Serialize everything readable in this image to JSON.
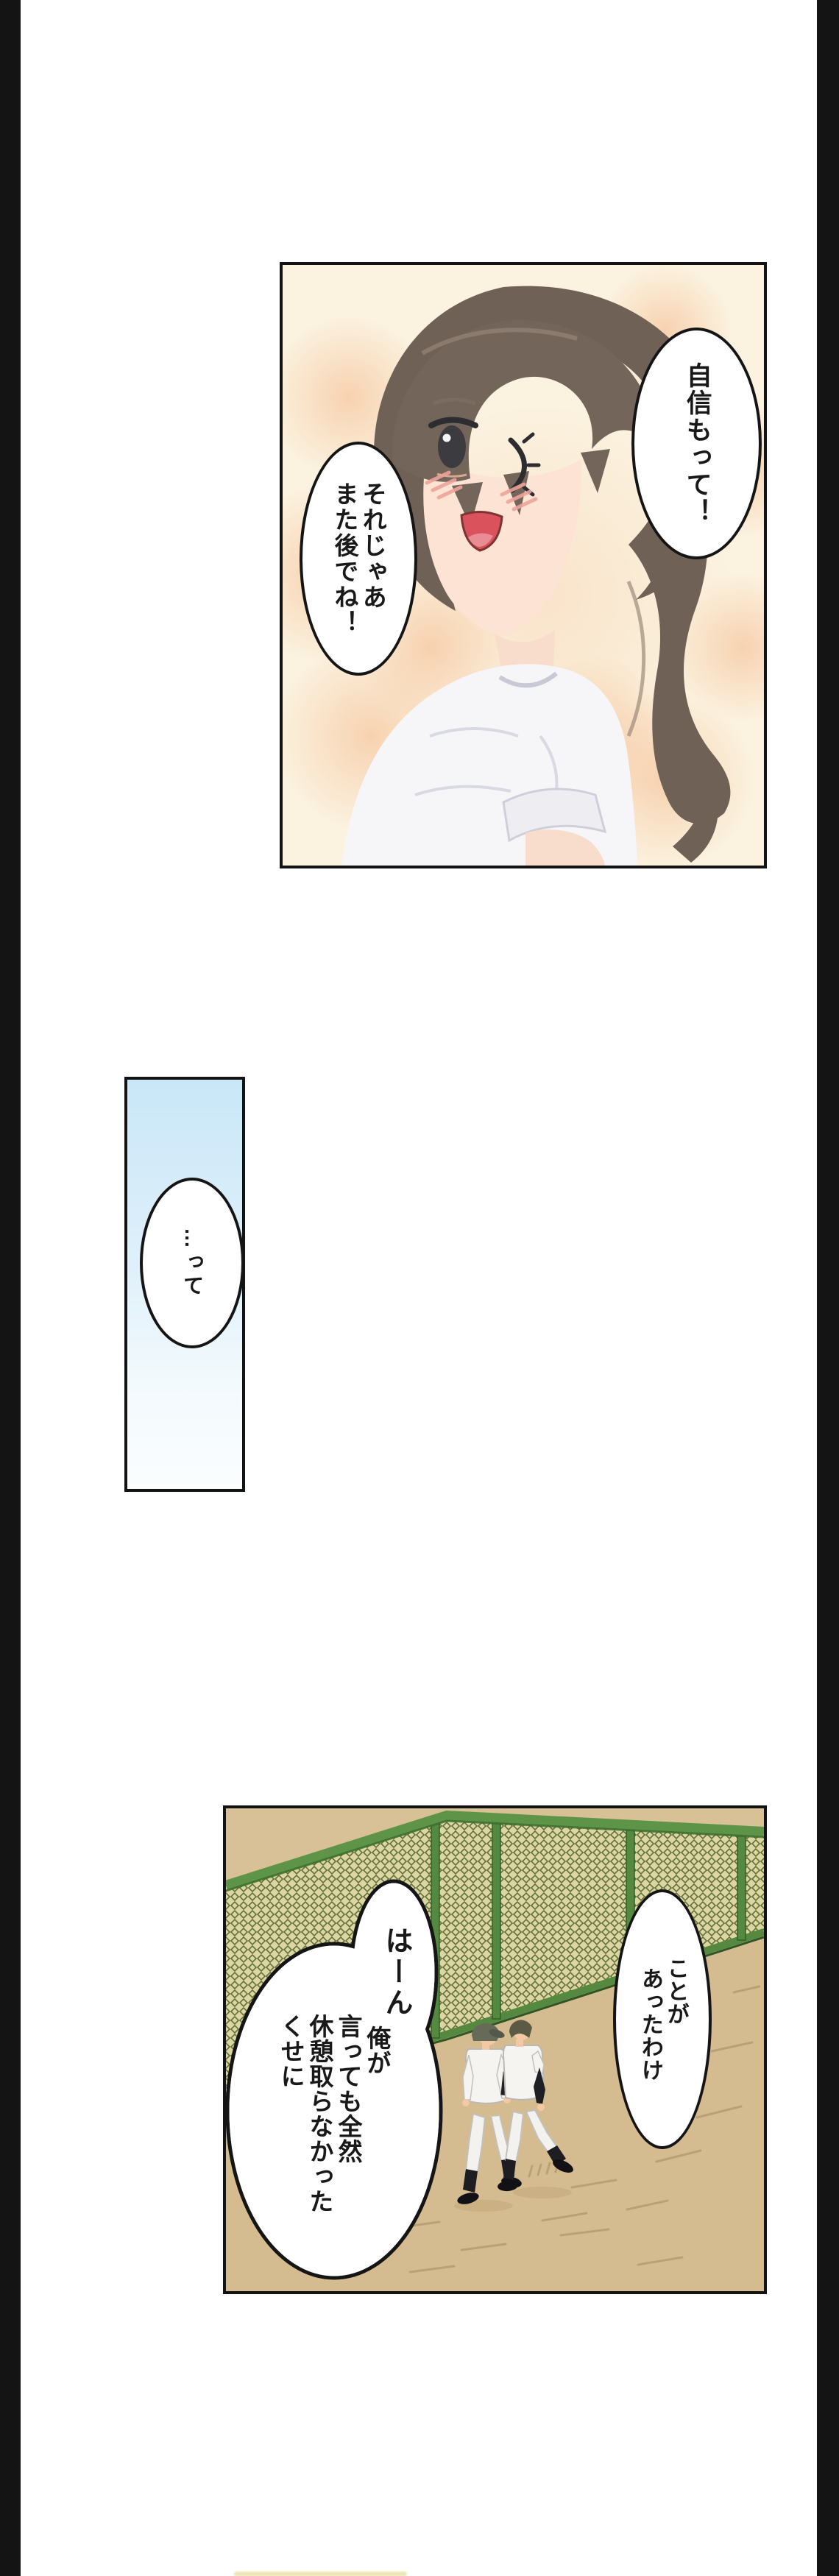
{
  "page": {
    "background": "#ffffff",
    "letterbox_color": "#141414",
    "bottom_sliver_color": "#e9e2a6"
  },
  "panel_girl": {
    "bubble_confidence": {
      "text": "自信もって！"
    },
    "bubble_see_you": {
      "lines": [
        "それじゃあ",
        "また後でね！"
      ]
    },
    "colors": {
      "background": "#fbf2df",
      "blotch": "#f6c7a0",
      "hair": "#6f6156",
      "skin": "#fde3d3",
      "shirt": "#f6f6f8",
      "mouth": "#d9525c"
    }
  },
  "panel_pause": {
    "bubble": {
      "text": "…って"
    },
    "colors": {
      "gradient_top": "#c9e7f8",
      "gradient_bottom": "#fbfdfe"
    }
  },
  "panel_field": {
    "bubble_happened": {
      "lines": [
        "ことが",
        "あったわけ"
      ]
    },
    "bubble_retort": {
      "exclaim": "はーん",
      "lines": [
        "俺が",
        "言っても全然",
        "休憩取らなかった",
        "くせに"
      ]
    },
    "colors": {
      "ground": "#d5bc90",
      "fence_mesh": "#ddd6a4",
      "fence_line": "#5f7136",
      "rail": "#5e9447",
      "uniform": "#f5f4f1",
      "cap": "#666a58",
      "skin": "#f2c9a4"
    }
  }
}
